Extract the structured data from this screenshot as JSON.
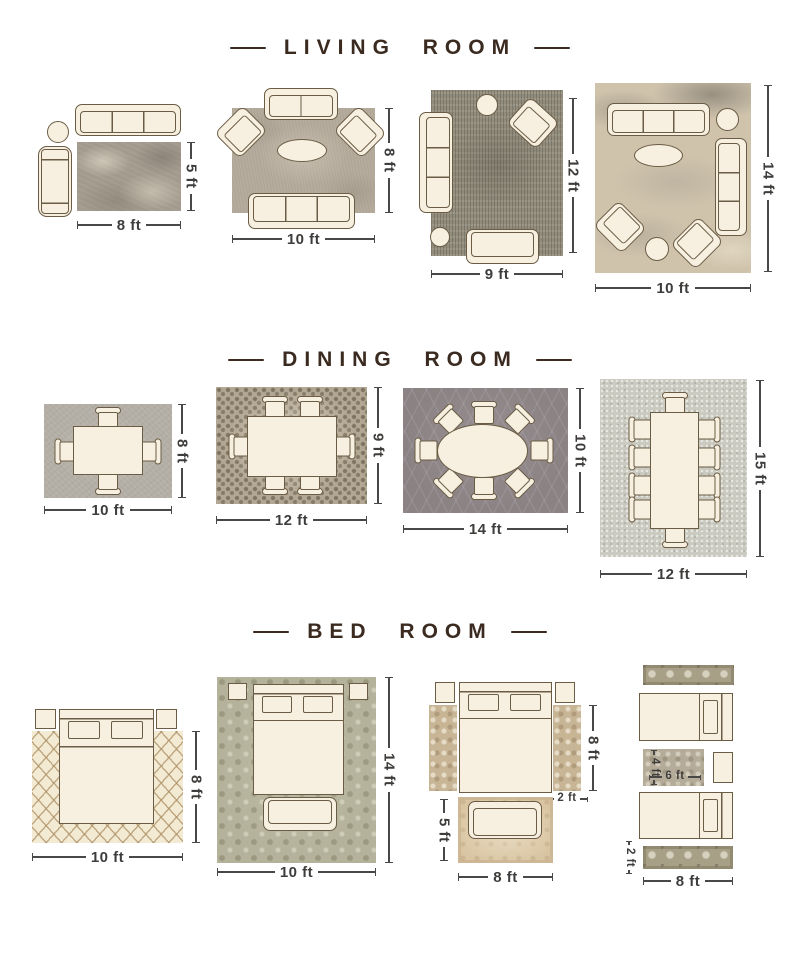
{
  "sections": [
    {
      "id": "living-room",
      "title": "LIVING ROOM",
      "layouts": [
        {
          "rug_width": "8 ft",
          "rug_height": "5 ft"
        },
        {
          "rug_width": "10 ft",
          "rug_height": "8 ft"
        },
        {
          "rug_width": "9 ft",
          "rug_height": "12 ft"
        },
        {
          "rug_width": "10 ft",
          "rug_height": "14 ft"
        }
      ]
    },
    {
      "id": "dining-room",
      "title": "DINING ROOM",
      "layouts": [
        {
          "rug_width": "10 ft",
          "rug_height": "8 ft"
        },
        {
          "rug_width": "12 ft",
          "rug_height": "9 ft"
        },
        {
          "rug_width": "14 ft",
          "rug_height": "10 ft"
        },
        {
          "rug_width": "12 ft",
          "rug_height": "15 ft"
        }
      ]
    },
    {
      "id": "bed-room",
      "title": "BED ROOM",
      "layouts": [
        {
          "rug_width": "10 ft",
          "rug_height": "8 ft"
        },
        {
          "rug_width": "10 ft",
          "rug_height": "14 ft"
        },
        {
          "bed_side_height": "8 ft",
          "runner_width": "2 ft",
          "front_rug_height": "5 ft",
          "front_rug_width": "8 ft"
        },
        {
          "small_rug_height": "4 ft",
          "small_rug_width": "6 ft",
          "runner_height": "2 ft",
          "runner_width": "8 ft"
        }
      ]
    }
  ],
  "colors": {
    "background": "#ffffff",
    "title_text": "#3a2a1f",
    "dimension_text": "#3f3d3b",
    "furniture_fill": "#f7f0e0",
    "furniture_outline": "#6b5c45"
  }
}
